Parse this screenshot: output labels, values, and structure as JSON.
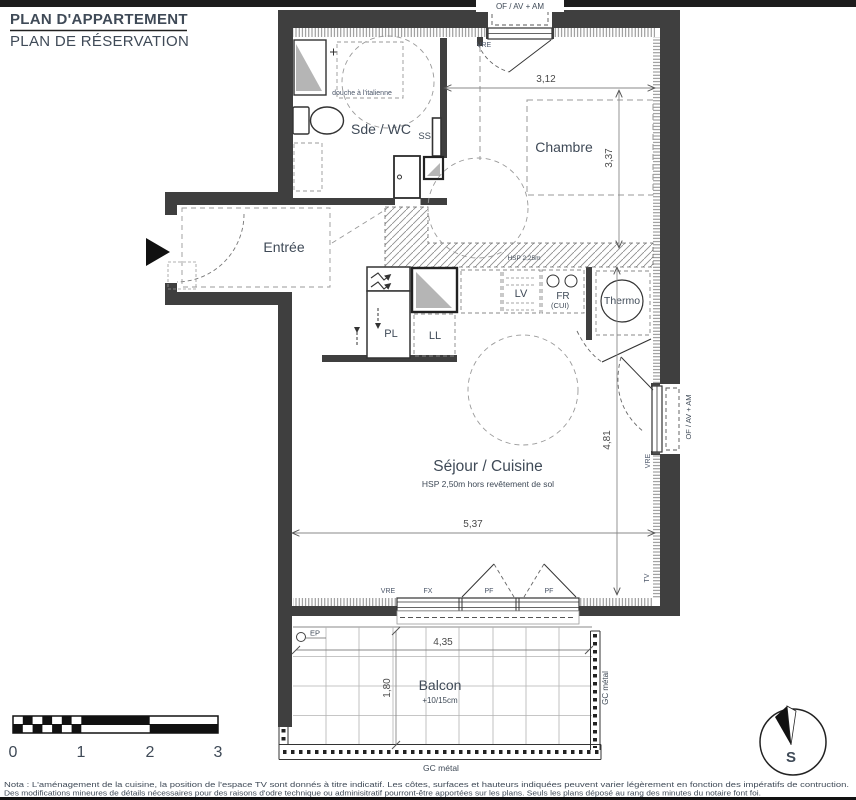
{
  "header": {
    "title": "PLAN D'APPARTEMENT",
    "subtitle": "PLAN DE RÉSERVATION"
  },
  "rooms": {
    "sde_wc": "Sde / WC",
    "chambre": "Chambre",
    "entree": "Entrée",
    "sejour": "Séjour / Cuisine",
    "sejour_note": "HSP 2,50m hors revêtement de sol",
    "balcon": "Balcon",
    "balcon_note": "+10/15cm",
    "thermo": "Thermo"
  },
  "equipment": {
    "douche": "douche à l'italienne",
    "seche_serviettes": "SS",
    "placard": "PL",
    "lave_linge": "LL",
    "lave_vaisselle": "LV",
    "frigo": "FR",
    "cuisine": "(CUI)",
    "eaux_pluviales": "EP",
    "soffit": "HSP 2,25m"
  },
  "openings": {
    "top_window": "OF / AV + AM",
    "right_window": "OF / AV + AM",
    "vre_top": "VRE",
    "vre_right": "VRE",
    "vre_bottom": "VRE",
    "fixed": "FX",
    "pf_left": "PF",
    "pf_right": "PF",
    "tv": "TV",
    "gc_bottom": "GC métal",
    "gc_right": "GC métal"
  },
  "dimensions": {
    "chambre_width": "3,12",
    "chambre_height": "3,37",
    "sejour_width": "5,37",
    "sejour_height": "4,81",
    "balcon_width": "4,35",
    "balcon_depth": "1,80"
  },
  "scalebar": {
    "t0": "0",
    "t1": "1",
    "t2": "2",
    "t3": "3"
  },
  "compass": {
    "south": "S"
  },
  "nota": {
    "line1": "Nota : L'aménagement de la cuisine, la position de l'espace TV sont donnés à titre indicatif. Les côtes, surfaces et hauteurs indiquées peuvent varier légèrement en fonction des impératifs de contruction.",
    "line2": "Des modifications mineures de détails nécessaires pour des raisons d'odre technique ou adminisitratif pourront-être apportées sur les plans. Seuls les plans déposé au rang des minutes du notaire font foi."
  }
}
